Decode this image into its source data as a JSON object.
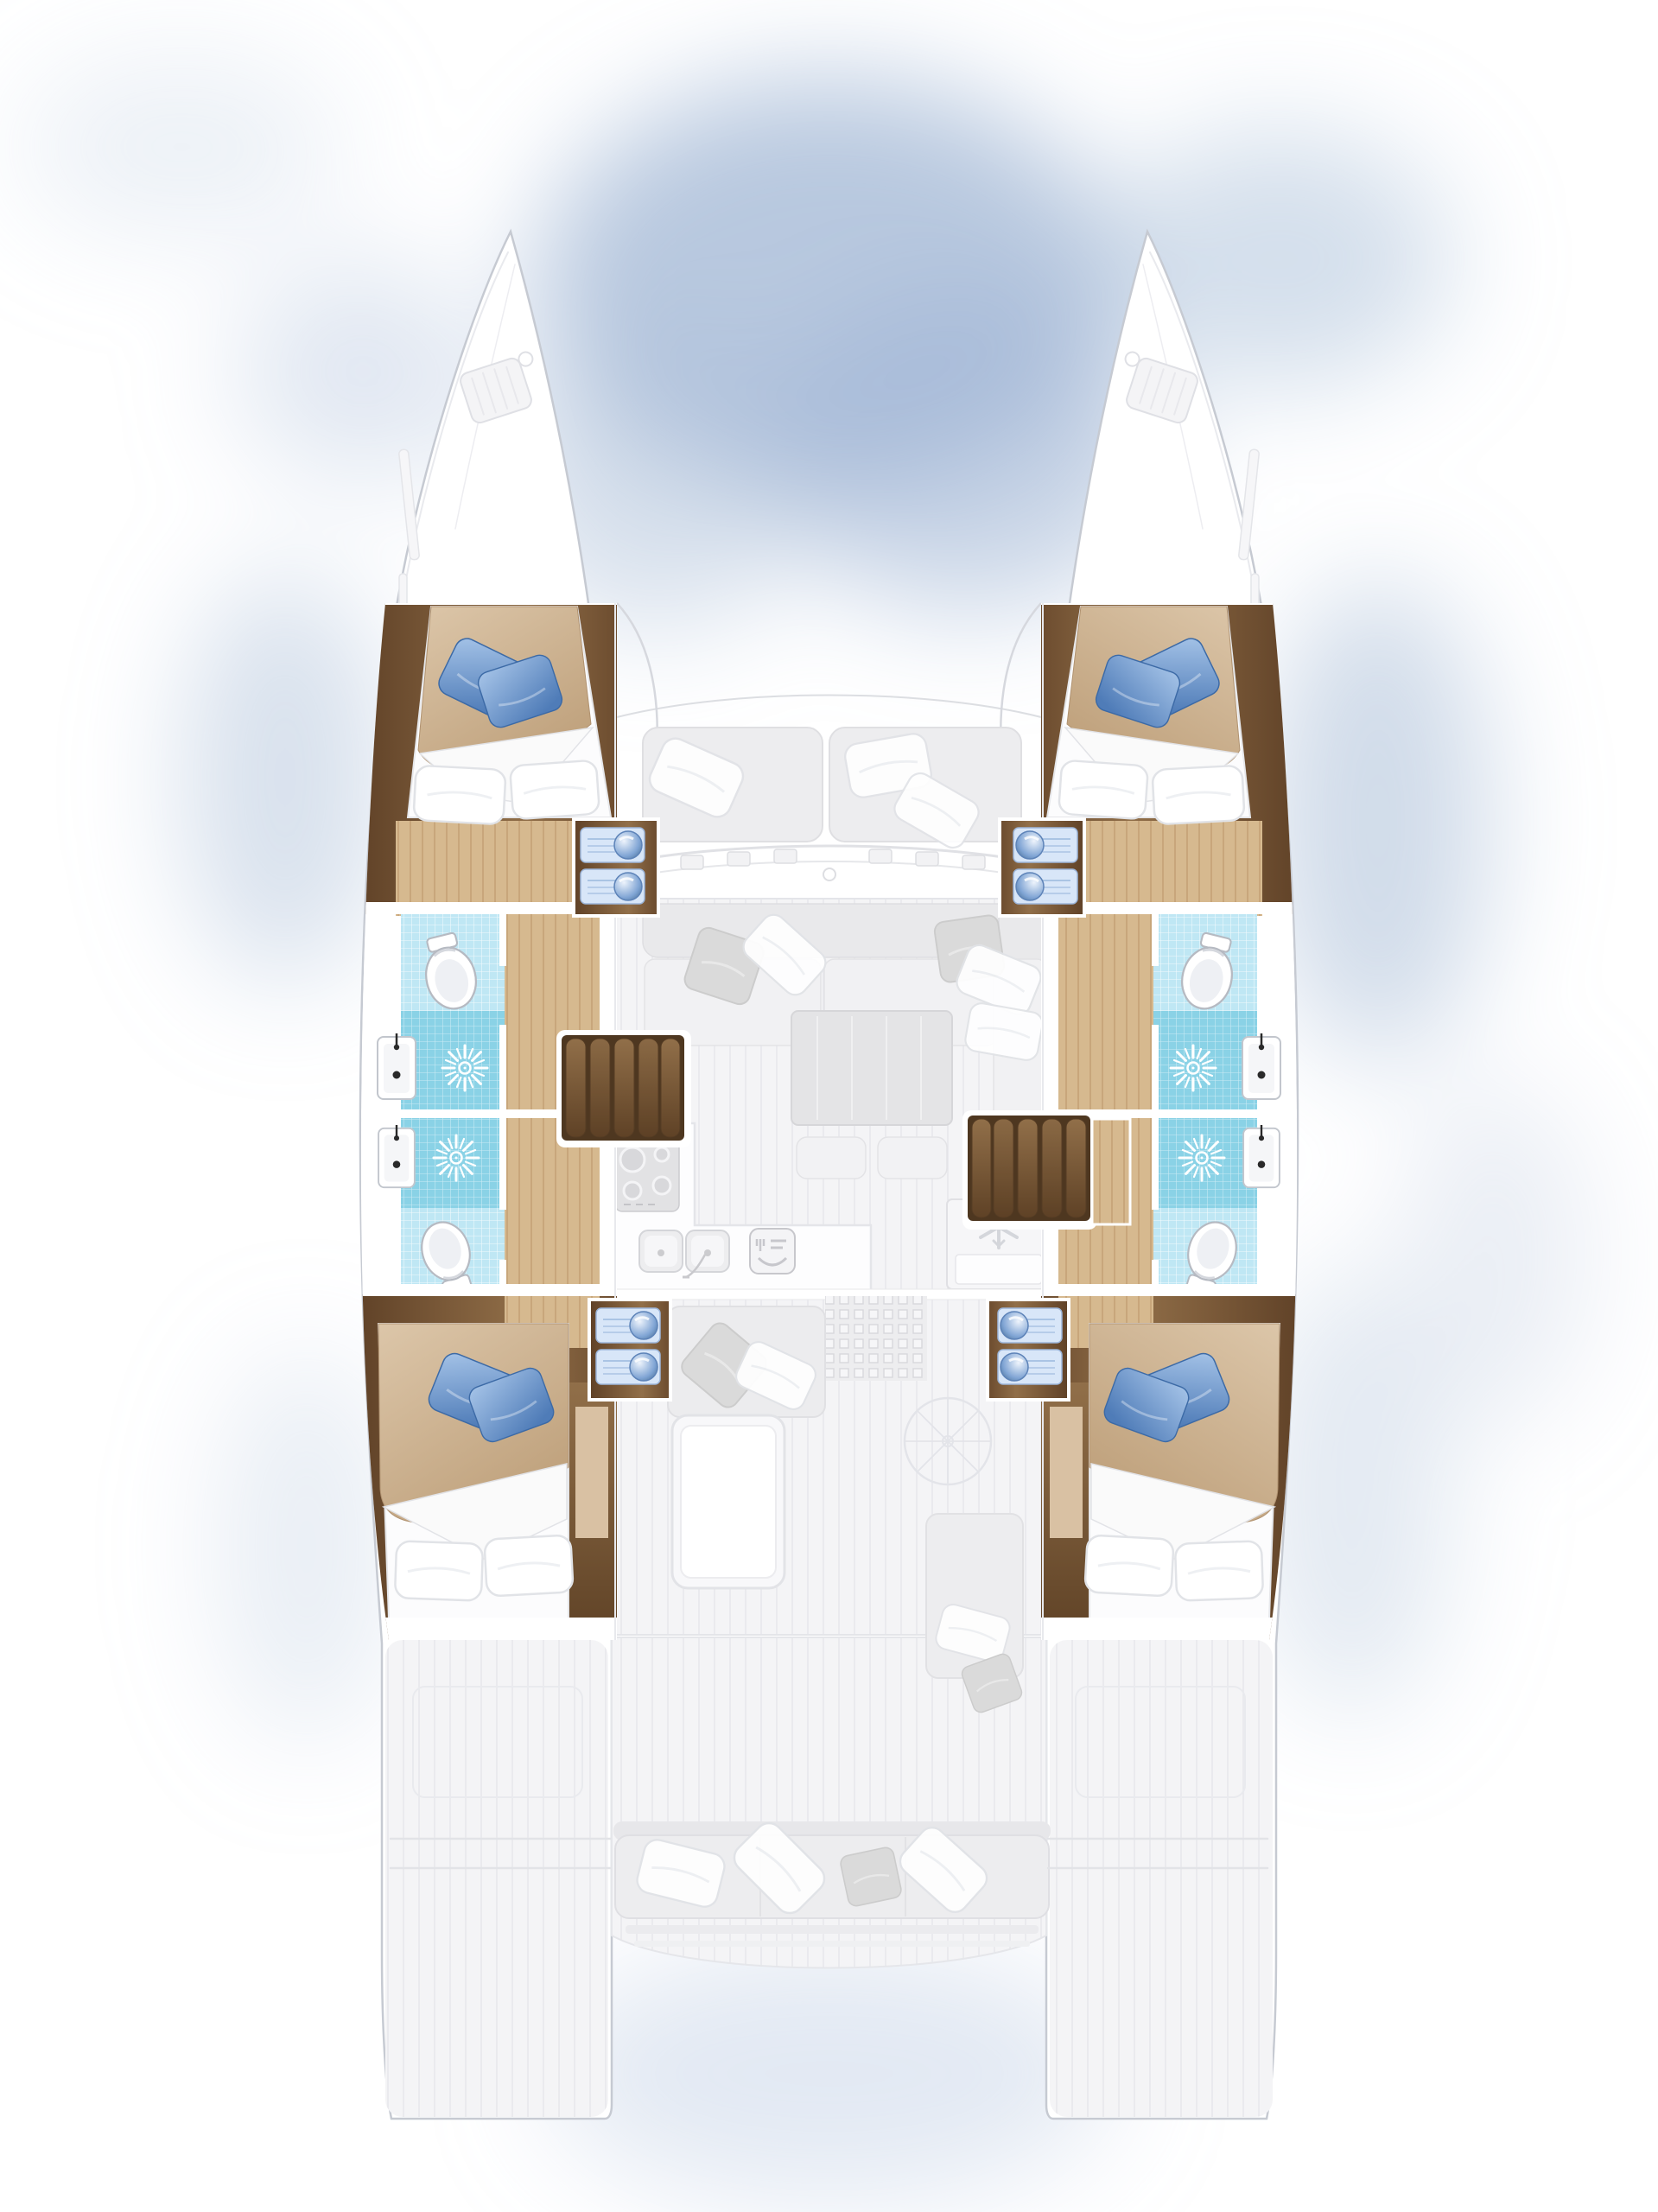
{
  "diagram": {
    "type": "boat-floor-plan",
    "vessel": "sailing-catamaran",
    "view": "top-down-interior-layout",
    "orientation": "bow-up",
    "decks": {
      "port_hull": [
        "double-cabin-forward",
        "vanity-with-two-basins",
        "bathroom-forward-with-shower-and-toilet",
        "corridor",
        "bathroom-aft-with-shower-and-toilet",
        "vanity-with-two-basins",
        "double-cabin-aft"
      ],
      "starboard_hull": [
        "double-cabin-forward",
        "vanity-with-two-basins",
        "bathroom-forward-with-shower-and-toilet",
        "corridor",
        "bathroom-aft-with-shower-and-toilet",
        "vanity-with-two-basins",
        "double-cabin-aft"
      ],
      "main_deck": [
        "trampoline-foredeck",
        "forward-cockpit-bench",
        "windshield-with-winches",
        "saloon-sofa",
        "saloon-dining-table",
        "two-ottomans",
        "galley-cooktop",
        "galley-double-sink",
        "dishwasher",
        "refrigerator",
        "port-stairs",
        "starboard-stairs",
        "doormat",
        "aft-cockpit-seat",
        "aft-cockpit-table",
        "helm-wheel",
        "helm-seat",
        "stern-bench",
        "swim-platforms"
      ]
    },
    "feature_counts": {
      "hulls": 2,
      "double_cabins": 4,
      "bathrooms": 4,
      "showers": 4,
      "toilets": 4,
      "bathroom_sinks": 4,
      "cabin_vanity_basins": 8,
      "cooktop_burners": 4,
      "galley_sink_bowls": 2,
      "refrigerators": 1,
      "stair_flights": 2,
      "cockpit_tables": 1,
      "saloon_tables": 1,
      "helm_stations": 1,
      "swim_platforms": 2
    }
  },
  "icons": [
    "shower-sunburst-icon",
    "toilet-icon",
    "bathroom-sink-icon",
    "vanity-basin-icon",
    "cooktop-burners-icon",
    "galley-double-sink-icon",
    "dishwasher-fork-plate-icon",
    "fridge-snowflake-icon",
    "doormat-grid-icon",
    "stair-treads-icon",
    "helm-wheel-icon",
    "bow-hatch-icon",
    "pillow-icon"
  ],
  "colors": {
    "background": "#ffffff",
    "cloud": "#a0b6d4",
    "cloud_soft": "#b6c6dd",
    "hull_fill": "#ffffff",
    "hull_stroke": "#c6cad2",
    "faded_line": "#e2e3e8",
    "deck_fill": "#f4f4f6",
    "wood_dark": "#5f4127",
    "wood_mid": "#7b5a39",
    "wood_light": "#916f49",
    "floor_light": "#d6b98f",
    "floor_line": "#bb9468",
    "tile_base": "#bfe7f4",
    "tile_shower": "#8ad2e6",
    "tile_grid": "#ffffff",
    "blanket_light": "#dcc6a9",
    "blanket_dark": "#bfa17c",
    "mattress": "#fcfcfd",
    "pillow_white": "#ffffff",
    "pillow_gray": "#dadada",
    "pillow_blue_light": "#a6c4e8",
    "pillow_blue_dark": "#4f7cb8",
    "vanity_panel": "#d8e6f8",
    "vanity_bowl": "#7fa4d4",
    "fixture_stroke": "#b6bac2",
    "sofa_fill": "#ececee",
    "table_fill": "#e4e4e6",
    "tan_inset": "#d9c1a3"
  }
}
